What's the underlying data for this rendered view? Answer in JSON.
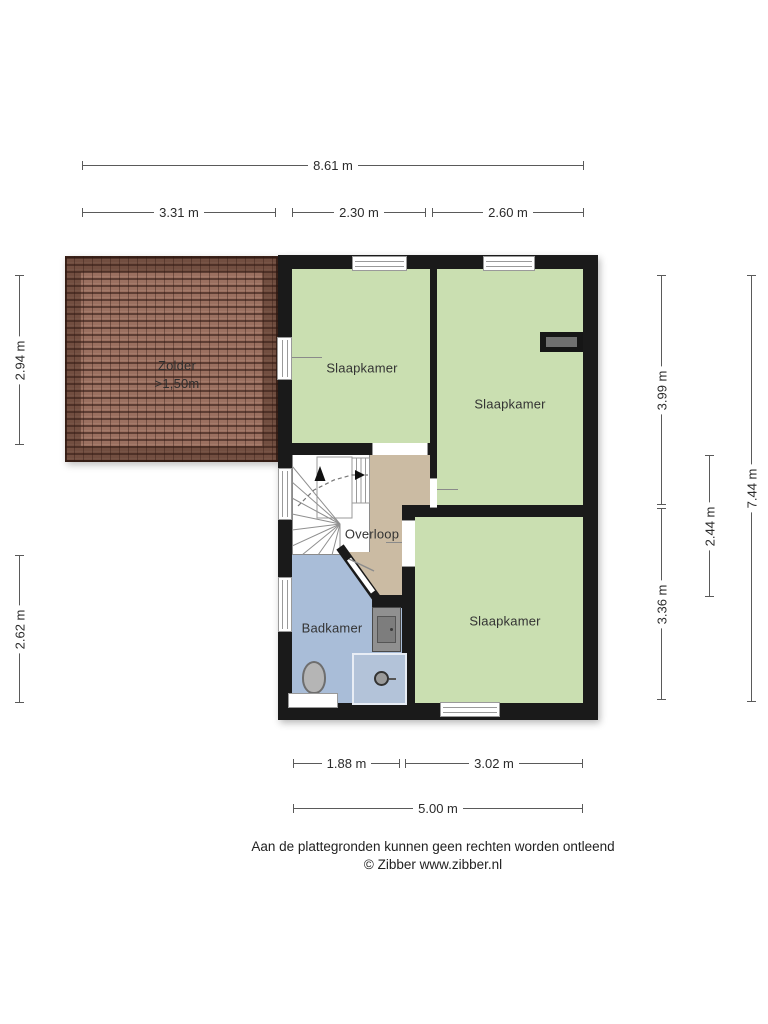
{
  "plan": {
    "rooms": {
      "zolder": {
        "label": "Zolder",
        "height_note": ">1,50m"
      },
      "slaapkamer_top_left": {
        "label": "Slaapkamer"
      },
      "slaapkamer_right": {
        "label": "Slaapkamer"
      },
      "slaapkamer_bottom_right": {
        "label": "Slaapkamer"
      },
      "overloop": {
        "label": "Overloop"
      },
      "badkamer": {
        "label": "Badkamer"
      }
    },
    "colors": {
      "wall": "#1a1a1a",
      "bedroom_fill": "#cadfb1",
      "landing_fill": "#cbbba3",
      "bathroom_fill": "#a9bdd8",
      "roof_tile": "#9b7060",
      "shower_fill": "#b3c3d9"
    }
  },
  "dimensions": {
    "top_total": "8.61 m",
    "top_segments": [
      "3.31 m",
      "2.30 m",
      "2.60 m"
    ],
    "left_segments": [
      "2.94 m",
      "2.62 m"
    ],
    "right_segments": [
      "3.99 m",
      "3.36 m"
    ],
    "right_middle": "2.44 m",
    "right_total": "7.44 m",
    "bottom_segments": [
      "1.88 m",
      "3.02 m"
    ],
    "bottom_total": "5.00 m"
  },
  "footer": {
    "disclaimer": "Aan de plattegronden kunnen geen rechten worden ontleend",
    "credit": "© Zibber www.zibber.nl"
  }
}
